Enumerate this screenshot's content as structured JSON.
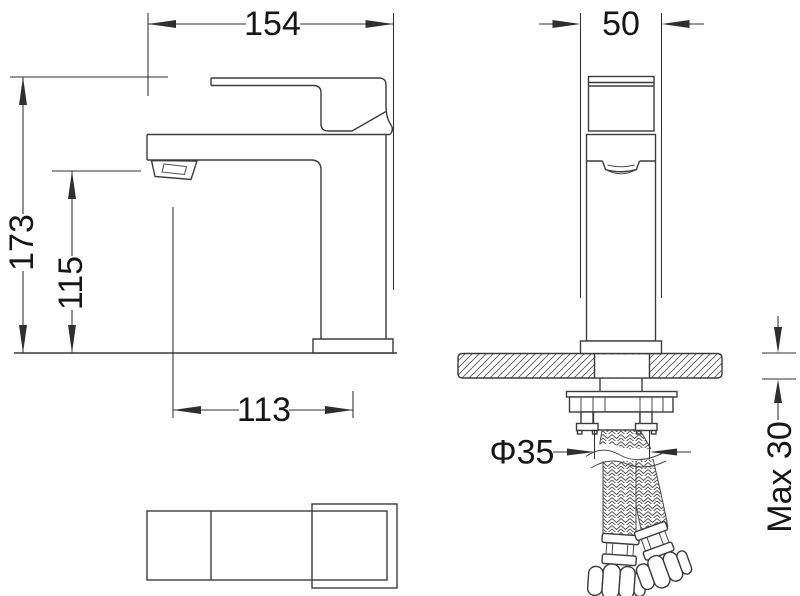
{
  "drawing": {
    "background": "#ffffff",
    "line_color": "#3b3b3b",
    "text_color": "#161616",
    "dimensions": {
      "spout_reach": "154",
      "body_width": "50",
      "overall_height": "173",
      "spout_height": "115",
      "spout_center_offset": "113",
      "mounting_hole_diameter": "Φ35",
      "max_deck_thickness": "Max 30"
    }
  }
}
